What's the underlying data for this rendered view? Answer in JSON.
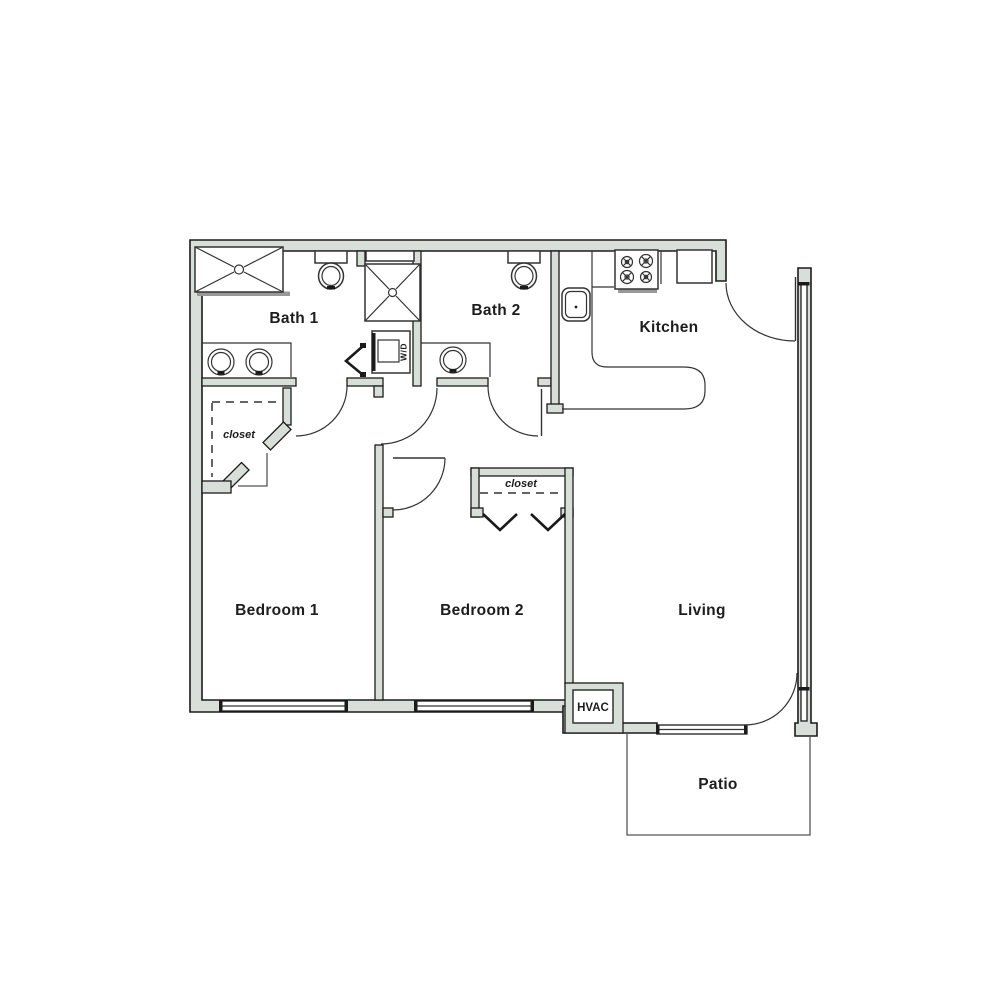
{
  "plan": {
    "title": "2 bed 2 bath apartment floor plan",
    "rooms": {
      "bath1": {
        "label": "Bath 1"
      },
      "bath2": {
        "label": "Bath 2"
      },
      "kitchen": {
        "label": "Kitchen"
      },
      "bedroom1": {
        "label": "Bedroom 1"
      },
      "bedroom2": {
        "label": "Bedroom 2"
      },
      "living": {
        "label": "Living"
      },
      "patio": {
        "label": "Patio"
      },
      "hvac": {
        "label": "HVAC"
      },
      "closet1": {
        "label": "closet"
      },
      "closet2": {
        "label": "closet"
      },
      "laundry": {
        "label": "W/D"
      }
    },
    "colors": {
      "background": "#ffffff",
      "wall": "#d8dfd8",
      "outline": "#1b1b1b",
      "fixture": "#333333",
      "faint": "#999999",
      "text": "#1d1d1d"
    }
  }
}
